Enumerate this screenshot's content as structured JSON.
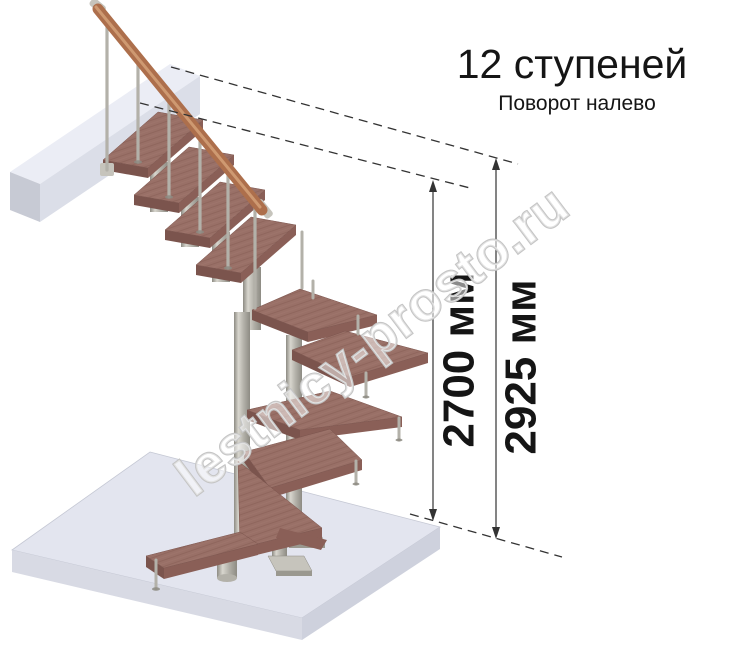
{
  "header": {
    "title": "12 ступеней",
    "subtitle": "Поворот налево"
  },
  "dimensions": {
    "items": [
      {
        "label": "2700 мм"
      },
      {
        "label": "2925 мм"
      }
    ]
  },
  "watermark": {
    "text": "lestnicy-prosto.ru"
  },
  "colors": {
    "wood-top": "#997067",
    "wood-grain": "#875d55",
    "wood-grain-light": "#a67b72",
    "wood-front": "#7b544d",
    "wood-side": "#8a5f57",
    "metal-light": "#d8d6ce",
    "metal-mid": "#b3b1a9",
    "metal-dark": "#8d8b83",
    "plate": "#c6c4bc",
    "plate-side": "#9a988f",
    "floor-top": "#e3e5ef",
    "floor-side-r": "#ced1dd",
    "floor-side-l": "#d8dae4",
    "floor-edge": "#c5c8d4",
    "beam-top": "#ebedf5",
    "beam-front": "#dbdee8",
    "beam-end": "#c7cad4",
    "rail": "#ad6f4c",
    "rail-light": "#d9a77e",
    "ink": "#333333",
    "text-dark": "#151515",
    "wm-stroke": "#c5c5c5",
    "wm-fill": "rgba(255,255,255,0.5)"
  }
}
